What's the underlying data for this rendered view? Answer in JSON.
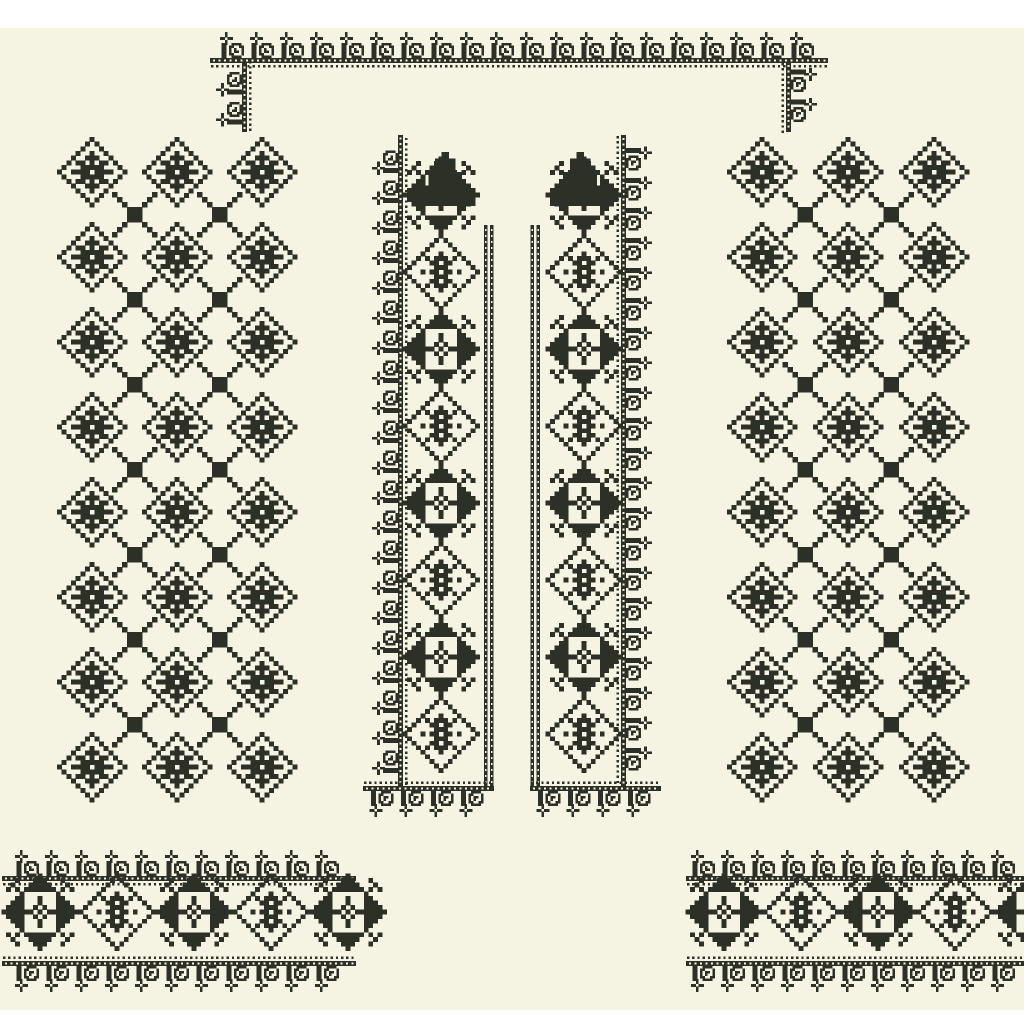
{
  "artwork": {
    "kind": "cross-stitch-embroidery-pattern",
    "palette": {
      "page_background": "#ffffff",
      "fabric": "#f5f3e2",
      "ink": "#2d3026"
    },
    "fabric_rect": {
      "x": 0,
      "y": 28,
      "w": 1024,
      "h": 982
    },
    "motif_bitmaps": {
      "diamond": [
        ".......X.......",
        "......X.X......",
        ".....X...X.....",
        "....X..X..X....",
        "...X..XXX..X...",
        "..X.XX.X.XX.X..",
        ".X...XXXXX...X.",
        "X..XXXX.XXXX..X",
        ".X...XXXXX...X.",
        "..X.XX.X.XX.X..",
        "...X..XXX..X...",
        "....X..X..X....",
        ".....X...X.....",
        "......X.X......",
        ".......X......."
      ],
      "star": [
        "........X........",
        "...X...XXX...X...",
        "..X...XXXXX...X..",
        ".X.X.XXXXXXX.X.X.",
        "....X.......X....",
        "...XX...X...XX...",
        "..XXX...X...XXX..",
        ".XXXX..X.X..XXXX.",
        "XXXXXXX.X.XXXXXXX",
        ".XXXX..X.X..XXXX.",
        "..XXX...X...XXX..",
        "...XX...X...XX...",
        "....X.......X....",
        ".X.X.XXXXXXX.X.X.",
        "..X...XXXXX...X..",
        "...X...XXX...X...",
        "........X........"
      ],
      "medallion": [
        "........X........",
        ".......X.X.......",
        "......X...X......",
        ".....X.....X.....",
        "....X...X...X....",
        "...X.X.XXX.X.X...",
        "..X...XX.XX...X..",
        ".X.....XXX.....X.",
        "X...X.XX.XX.X...X",
        ".X.....XXX.....X.",
        "..X...XX.XX...X..",
        "...X.X.XXX.X.X...",
        "....X...X...X....",
        ".....X.....X.....",
        "......X...X......",
        ".......X.X.......",
        "........X........"
      ],
      "lattice_x": [
        "X.......X",
        ".X.....X.",
        "..X...X..",
        "...XXX...",
        "...XXX...",
        "...XXX...",
        "..X...X..",
        ".X.....X.",
        "X.......X"
      ],
      "curl": [
        ".XX..XXXX...",
        ".XX.XX..XX..",
        ".XX.X.X..X..",
        ".XX.X.XX.X..",
        ".XX.XX...X..",
        ".XX..XXXX..."
      ],
      "flower_cross": [
        "..X..",
        "..X..",
        "XX.XX",
        "..X..",
        "..X.."
      ],
      "peak": [
        "....X....",
        "...XXX...",
        "...XXX...",
        "..XXXXX..",
        "..XXXXX..",
        ".XXXXXXX.",
        ".XXXXXXX.",
        "XXXXXXXXX"
      ]
    },
    "cells": {
      "diamond": 4.67,
      "star": 4.53,
      "connector": 5,
      "peak": 6.7
    },
    "border_style": {
      "unit_w": 30,
      "curl_cell": 2.5,
      "cross_cell": 2.6,
      "line_h": 5,
      "dark_dot_gap": 5.2,
      "white_dot_gap": 5.5,
      "dark_dot_size": 2.3,
      "white_dot_size": 2.2
    },
    "top_border": {
      "x": 210,
      "y": 58,
      "length": 618,
      "corner_left": {
        "x": 242,
        "y": 132,
        "length": 70
      },
      "corner_right": {
        "x": 791,
        "y": 62,
        "length": 70
      }
    },
    "panels": {
      "cols_left": [
        92,
        177,
        262
      ],
      "cols_right": [
        762,
        848,
        934
      ],
      "rows": [
        172,
        257,
        342,
        427,
        512,
        597,
        682,
        767
      ]
    },
    "bands": {
      "top_y": 135,
      "bottom_y": 786,
      "motif_start_y": 195,
      "motif_period": 77,
      "motif_count": 8,
      "inner_bar_top_y": 225,
      "inner_bar_w": 3.6,
      "bottom_length": 131,
      "peak_top_y": 152,
      "left": {
        "outer_line_x": 398,
        "outer_rot": -90,
        "outer_origin_y": 786,
        "center_x": 441,
        "peak_dx": 4,
        "inner_bars_x": [
          484,
          490
        ],
        "bottom_x": 363
      },
      "right": {
        "outer_line_x": 626,
        "outer_rot": 90,
        "outer_origin_y": 135,
        "center_x": 584,
        "peak_dx": -4,
        "inner_bars_x": [
          530.5,
          536.5
        ],
        "bottom_x": 530
      }
    },
    "cuffs": {
      "line_y": 876,
      "bottom_line_y": 966,
      "motif_center_y": 912,
      "motif_period": 77,
      "left": {
        "x": 2,
        "length": 354,
        "motif_start_x": 40,
        "motif_count": 5
      },
      "right": {
        "x": 686,
        "length": 338,
        "motif_start_x": 724,
        "motif_count": 5
      }
    }
  }
}
